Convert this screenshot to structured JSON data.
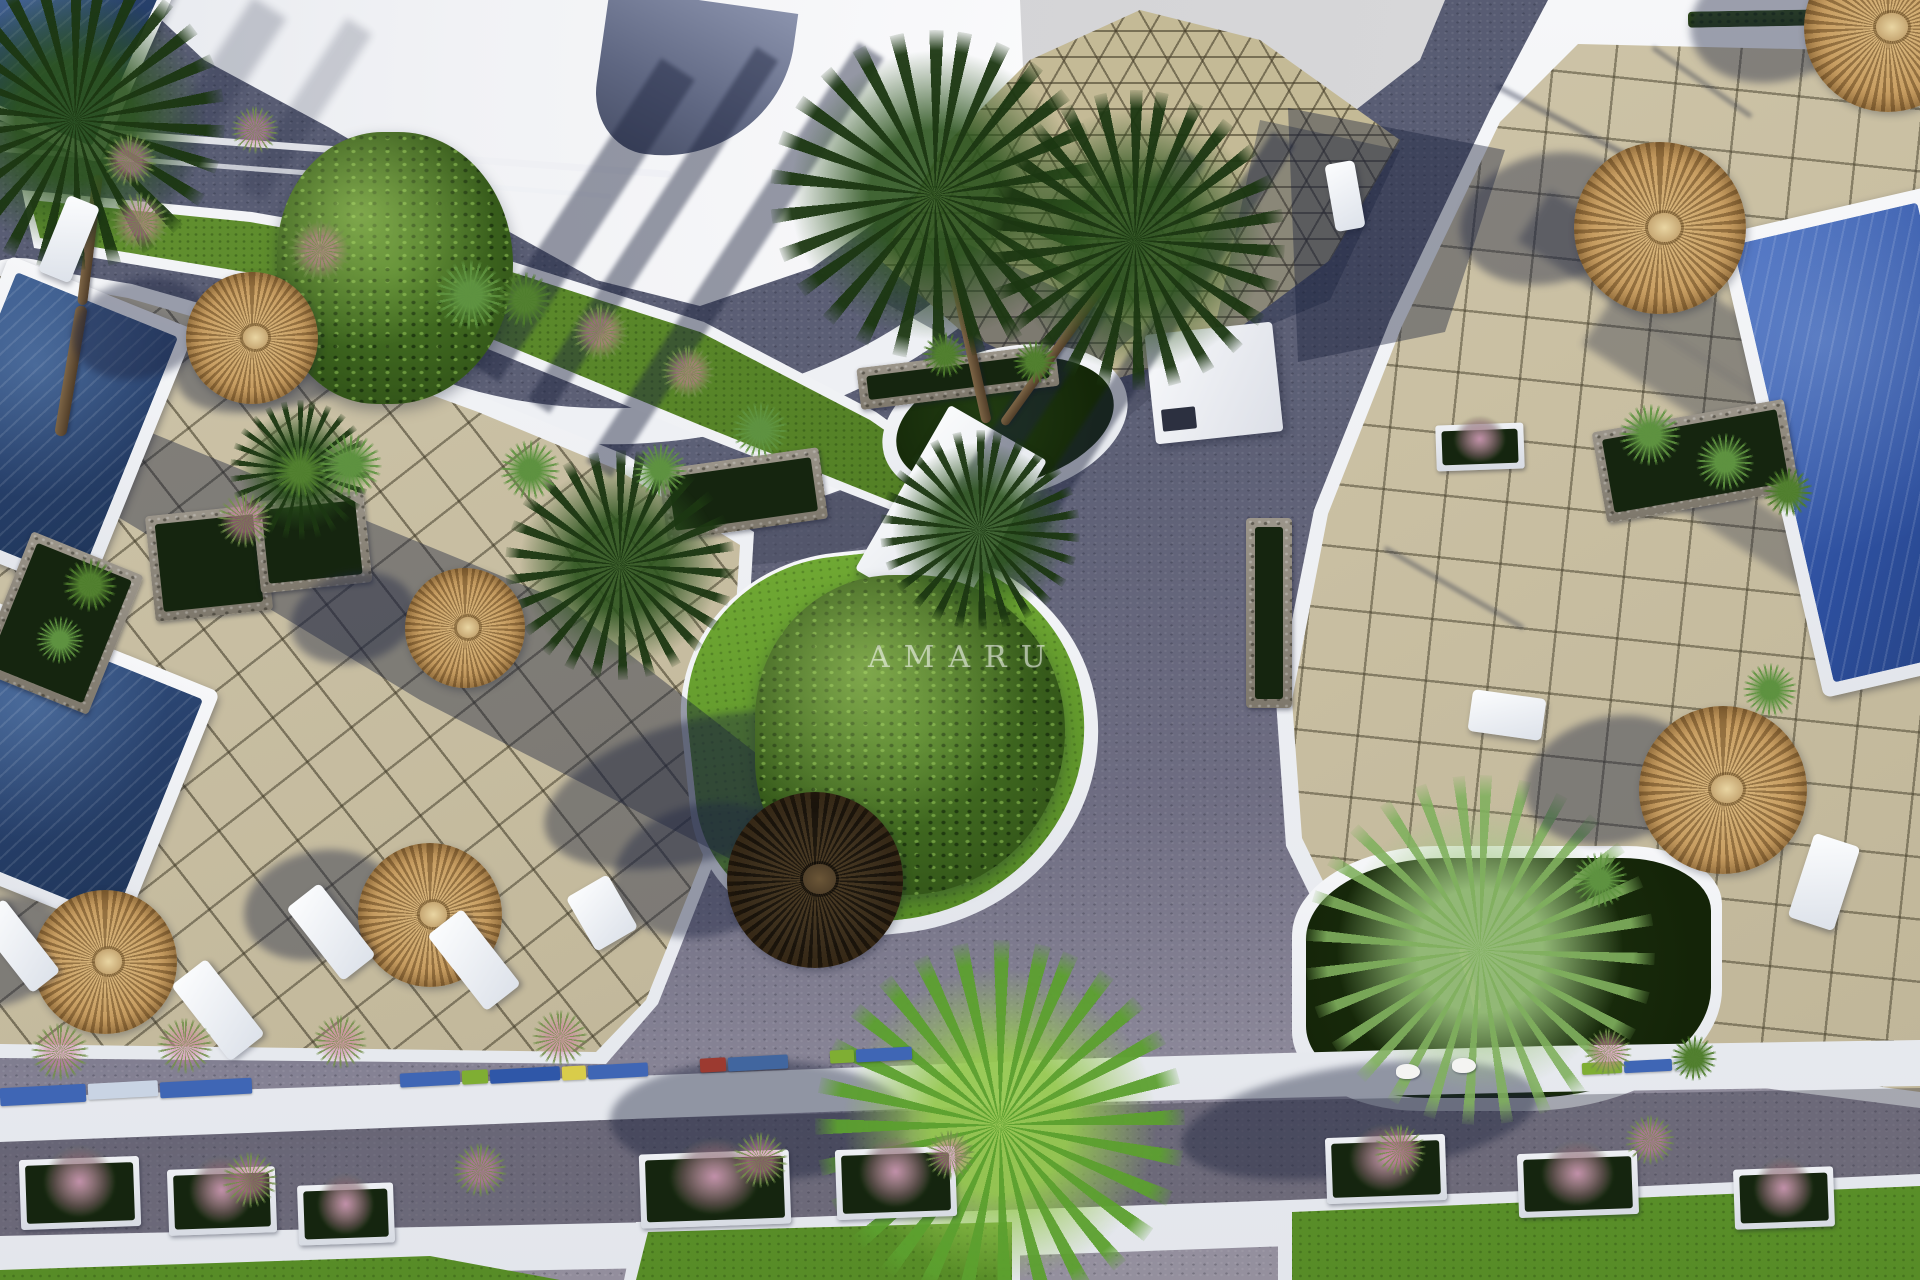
{
  "image": {
    "kind": "3d-aerial-architectural-render",
    "subject": "Resort courtyard with swimming pools, tiled sun terraces, thatch umbrellas, palm trees and winding roads"
  },
  "watermark": {
    "text": "AMARU"
  },
  "palette": {
    "sky": "#d3d3d5",
    "white_structure": "#f2f3f6",
    "road": "#5a5f75",
    "road_light": "#928d9d",
    "tile": "#cbc2a6",
    "tile_grout": "#5e5844",
    "lawn": "#55832a",
    "pool_dark": "#2a4269",
    "pool_bright": "#35569f",
    "umbrella_thatch": "#c49a5e",
    "umbrella_dark": "#3a2d1b",
    "palm_green": "#2f5420",
    "stone": "#8f897d",
    "flower_pink": "#c784a0"
  },
  "scene": {
    "pools": [
      {
        "x": -60,
        "y": -80,
        "w": 210,
        "h": 210,
        "rot": 24
      },
      {
        "x": -52,
        "y": 282,
        "w": 200,
        "h": 290,
        "rot": 22
      },
      {
        "x": -70,
        "y": 636,
        "w": 250,
        "h": 262,
        "rot": 22
      },
      {
        "x": 1768,
        "y": 205,
        "w": 215,
        "h": 475,
        "rot": -13,
        "bright": true
      }
    ],
    "umbrellas": [
      {
        "x": 252,
        "y": 338,
        "r": 66
      },
      {
        "x": 465,
        "y": 628,
        "r": 60
      },
      {
        "x": 105,
        "y": 962,
        "r": 72
      },
      {
        "x": 430,
        "y": 915,
        "r": 72
      },
      {
        "x": 815,
        "y": 880,
        "r": 88,
        "shade": "dark"
      },
      {
        "x": 1660,
        "y": 228,
        "r": 86
      },
      {
        "x": 1723,
        "y": 790,
        "r": 84
      },
      {
        "x": 1888,
        "y": 28,
        "r": 84
      }
    ],
    "palms": [
      {
        "x": 935,
        "y": 195,
        "r": 165,
        "type": "dark"
      },
      {
        "x": 1135,
        "y": 240,
        "r": 150,
        "type": "dark"
      },
      {
        "x": 620,
        "y": 565,
        "r": 115,
        "type": "dark"
      },
      {
        "x": 980,
        "y": 530,
        "r": 100,
        "type": "dark"
      },
      {
        "x": 75,
        "y": 120,
        "r": 150,
        "type": "dark"
      },
      {
        "x": 300,
        "y": 470,
        "r": 70,
        "type": "dark"
      },
      {
        "x": 1000,
        "y": 1125,
        "r": 185,
        "type": "bright"
      },
      {
        "x": 1480,
        "y": 950,
        "r": 175,
        "type": "light"
      }
    ],
    "trunks": [
      {
        "x1": 987,
        "y1": 418,
        "x2": 948,
        "y2": 242,
        "w": 10
      },
      {
        "x1": 1003,
        "y1": 420,
        "x2": 1112,
        "y2": 268,
        "w": 9
      },
      {
        "x1": 60,
        "y1": 430,
        "x2": 82,
        "y2": 300,
        "w": 12
      },
      {
        "x1": 82,
        "y1": 300,
        "x2": 98,
        "y2": 170,
        "w": 10
      },
      {
        "x1": 1478,
        "y1": 1005,
        "x2": 1462,
        "y2": 944,
        "w": 8
      }
    ],
    "loungers": [
      {
        "x": 52,
        "y": 198,
        "w": 34,
        "h": 82,
        "rot": 22
      },
      {
        "x": 0,
        "y": 900,
        "w": 36,
        "h": 92,
        "rot": -38
      },
      {
        "x": 196,
        "y": 962,
        "w": 44,
        "h": 96,
        "rot": -38
      },
      {
        "x": 310,
        "y": 886,
        "w": 42,
        "h": 92,
        "rot": -38
      },
      {
        "x": 452,
        "y": 912,
        "w": 44,
        "h": 96,
        "rot": -38
      },
      {
        "x": 578,
        "y": 882,
        "w": 48,
        "h": 62,
        "rot": -30
      },
      {
        "x": 1330,
        "y": 162,
        "w": 30,
        "h": 68,
        "rot": -10
      },
      {
        "x": 1800,
        "y": 838,
        "w": 48,
        "h": 88,
        "rot": 18
      },
      {
        "x": 1470,
        "y": 694,
        "w": 74,
        "h": 42,
        "rot": 8
      }
    ],
    "stone_planters": [
      {
        "x": 0,
        "y": 548,
        "w": 120,
        "h": 150,
        "rot": 22
      },
      {
        "x": 150,
        "y": 510,
        "w": 118,
        "h": 106,
        "rot": -6
      },
      {
        "x": 256,
        "y": 496,
        "w": 112,
        "h": 92,
        "rot": -6
      },
      {
        "x": 662,
        "y": 458,
        "w": 162,
        "h": 72,
        "rot": -8
      },
      {
        "x": 858,
        "y": 356,
        "w": 200,
        "h": 42,
        "rot": -7
      },
      {
        "x": 1246,
        "y": 518,
        "w": 46,
        "h": 190,
        "rot": 0
      },
      {
        "x": 1598,
        "y": 415,
        "w": 195,
        "h": 92,
        "rot": -10
      }
    ],
    "planter_boxes": [
      {
        "x": 20,
        "y": 1158,
        "w": 120,
        "h": 70
      },
      {
        "x": 168,
        "y": 1168,
        "w": 108,
        "h": 66
      },
      {
        "x": 298,
        "y": 1184,
        "w": 96,
        "h": 60
      },
      {
        "x": 640,
        "y": 1152,
        "w": 150,
        "h": 74
      },
      {
        "x": 836,
        "y": 1148,
        "w": 120,
        "h": 70
      },
      {
        "x": 1326,
        "y": 1136,
        "w": 120,
        "h": 66
      },
      {
        "x": 1518,
        "y": 1152,
        "w": 120,
        "h": 64
      },
      {
        "x": 1734,
        "y": 1168,
        "w": 100,
        "h": 60
      },
      {
        "x": 1436,
        "y": 424,
        "w": 88,
        "h": 46
      }
    ],
    "accent_tiles": [
      {
        "x": 0,
        "y": 1086,
        "w": 86,
        "h": 18,
        "c": "#3f66b5"
      },
      {
        "x": 88,
        "y": 1082,
        "w": 70,
        "h": 16,
        "c": "#c9d4e4"
      },
      {
        "x": 160,
        "y": 1080,
        "w": 92,
        "h": 16,
        "c": "#3f66b5"
      },
      {
        "x": 400,
        "y": 1072,
        "w": 60,
        "h": 14,
        "c": "#3f66b5"
      },
      {
        "x": 462,
        "y": 1070,
        "w": 26,
        "h": 14,
        "c": "#7fae33"
      },
      {
        "x": 490,
        "y": 1068,
        "w": 70,
        "h": 14,
        "c": "#2f57a8"
      },
      {
        "x": 562,
        "y": 1066,
        "w": 24,
        "h": 14,
        "c": "#d9cc4a"
      },
      {
        "x": 588,
        "y": 1064,
        "w": 60,
        "h": 14,
        "c": "#3f66b5"
      },
      {
        "x": 700,
        "y": 1058,
        "w": 26,
        "h": 14,
        "c": "#9c3a30"
      },
      {
        "x": 728,
        "y": 1056,
        "w": 60,
        "h": 14,
        "c": "#41669f"
      },
      {
        "x": 830,
        "y": 1050,
        "w": 24,
        "h": 13,
        "c": "#7fae33"
      },
      {
        "x": 856,
        "y": 1048,
        "w": 56,
        "h": 13,
        "c": "#3f66b5"
      },
      {
        "x": 1582,
        "y": 1062,
        "w": 40,
        "h": 12,
        "c": "#7fae33"
      },
      {
        "x": 1624,
        "y": 1060,
        "w": 48,
        "h": 12,
        "c": "#3f66b5"
      },
      {
        "x": 1674,
        "y": 1058,
        "w": 30,
        "h": 12,
        "c": "#c9d4e4"
      }
    ],
    "plants": [
      {
        "x": 140,
        "y": 222,
        "s": 60,
        "kind": "pink"
      },
      {
        "x": 320,
        "y": 250,
        "s": 64,
        "kind": "pink"
      },
      {
        "x": 600,
        "y": 332,
        "s": 58,
        "kind": "pink"
      },
      {
        "x": 688,
        "y": 372,
        "s": 54,
        "kind": "pink"
      },
      {
        "x": 130,
        "y": 160,
        "s": 54,
        "kind": "pink"
      },
      {
        "x": 255,
        "y": 130,
        "s": 48,
        "kind": "pink"
      },
      {
        "x": 470,
        "y": 295,
        "s": 70,
        "kind": "fern"
      },
      {
        "x": 525,
        "y": 300,
        "s": 56,
        "kind": "green"
      },
      {
        "x": 350,
        "y": 465,
        "s": 64,
        "kind": "fern"
      },
      {
        "x": 300,
        "y": 472,
        "s": 52,
        "kind": "green"
      },
      {
        "x": 245,
        "y": 520,
        "s": 56,
        "kind": "pink"
      },
      {
        "x": 530,
        "y": 470,
        "s": 60,
        "kind": "fern"
      },
      {
        "x": 660,
        "y": 470,
        "s": 54,
        "kind": "fern"
      },
      {
        "x": 760,
        "y": 430,
        "s": 56,
        "kind": "fern"
      },
      {
        "x": 1650,
        "y": 435,
        "s": 62,
        "kind": "fern"
      },
      {
        "x": 1725,
        "y": 462,
        "s": 58,
        "kind": "fern"
      },
      {
        "x": 1788,
        "y": 492,
        "s": 50,
        "kind": "green"
      },
      {
        "x": 1770,
        "y": 690,
        "s": 54,
        "kind": "fern"
      },
      {
        "x": 1600,
        "y": 880,
        "s": 56,
        "kind": "fern"
      },
      {
        "x": 90,
        "y": 585,
        "s": 54,
        "kind": "green"
      },
      {
        "x": 60,
        "y": 640,
        "s": 48,
        "kind": "fern"
      },
      {
        "x": 945,
        "y": 355,
        "s": 46,
        "kind": "green"
      },
      {
        "x": 1035,
        "y": 362,
        "s": 44,
        "kind": "green"
      },
      {
        "x": 60,
        "y": 1052,
        "s": 58,
        "kind": "pink"
      },
      {
        "x": 185,
        "y": 1046,
        "s": 56,
        "kind": "pink"
      },
      {
        "x": 340,
        "y": 1042,
        "s": 54,
        "kind": "pink"
      },
      {
        "x": 560,
        "y": 1038,
        "s": 56,
        "kind": "pink"
      },
      {
        "x": 1608,
        "y": 1052,
        "s": 48,
        "kind": "pink"
      },
      {
        "x": 1694,
        "y": 1058,
        "s": 46,
        "kind": "green"
      },
      {
        "x": 250,
        "y": 1180,
        "s": 56,
        "kind": "pink"
      },
      {
        "x": 480,
        "y": 1170,
        "s": 54,
        "kind": "pink"
      },
      {
        "x": 760,
        "y": 1160,
        "s": 56,
        "kind": "pink"
      },
      {
        "x": 950,
        "y": 1155,
        "s": 50,
        "kind": "pink"
      },
      {
        "x": 1400,
        "y": 1150,
        "s": 52,
        "kind": "pink"
      },
      {
        "x": 1650,
        "y": 1140,
        "s": 50,
        "kind": "pink"
      }
    ],
    "figures": [
      {
        "x": 1396,
        "y": 1064
      },
      {
        "x": 1452,
        "y": 1058
      }
    ]
  }
}
